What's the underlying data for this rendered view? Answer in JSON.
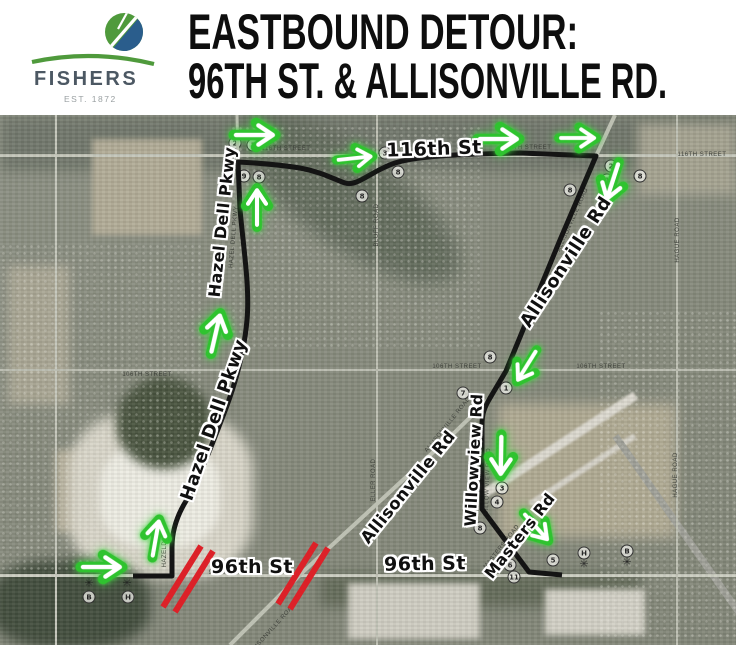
{
  "header": {
    "logo": {
      "name": "FISHERS",
      "est": "EST. 1872",
      "green": "#4f9a3c",
      "blue": "#2a5d8c"
    },
    "title_line1": "EASTBOUND DETOUR:",
    "title_line2": "96TH ST. & ALLISONVILLE RD."
  },
  "map": {
    "colors": {
      "route": "#141414",
      "arrow_green": "#2fc32f",
      "closure_red": "#dc2128"
    },
    "star": "✳",
    "route_labels": [
      {
        "text": "116th St"
      },
      {
        "text": "Hazel Dell Pkwy"
      },
      {
        "text": "Hazel Dell Pkwy"
      },
      {
        "text": "Allisonville Rd"
      },
      {
        "text": "Allisonville Rd"
      },
      {
        "text": "Willowview Rd"
      },
      {
        "text": "Masters Rd"
      },
      {
        "text": "96th St"
      },
      {
        "text": "96th St"
      }
    ],
    "base_labels": [
      {
        "text": "116TH STREET"
      },
      {
        "text": "116TH STREET"
      },
      {
        "text": "116TH STREET"
      },
      {
        "text": "106TH STREET"
      },
      {
        "text": "106TH STREET"
      },
      {
        "text": "106TH STREET"
      },
      {
        "text": "96TH"
      },
      {
        "text": "BLUFF ROAD"
      },
      {
        "text": "ELLER ROAD"
      },
      {
        "text": "HAGUE ROAD"
      },
      {
        "text": "HAGUE ROAD"
      },
      {
        "text": "ALLISONVILLE ROAD"
      },
      {
        "text": "ALLISONVILLE ROAD"
      },
      {
        "text": "ALLISONVILLE ROAD"
      },
      {
        "text": "WILLOW VIEW ROAD"
      },
      {
        "text": "MASTERS ROAD"
      },
      {
        "text": "HAZEL DELL PKWY"
      },
      {
        "text": "HAZELDELL"
      }
    ],
    "markers": [
      {
        "t": "2"
      },
      {
        "t": "1"
      },
      {
        "t": "9"
      },
      {
        "t": "8"
      },
      {
        "t": "3"
      },
      {
        "t": "8"
      },
      {
        "t": "8"
      },
      {
        "t": "2"
      },
      {
        "t": "1"
      },
      {
        "t": "8"
      },
      {
        "t": "8"
      },
      {
        "t": "8"
      },
      {
        "t": "7"
      },
      {
        "t": "1"
      },
      {
        "t": "3"
      },
      {
        "t": "4"
      },
      {
        "t": "8"
      },
      {
        "t": "5"
      },
      {
        "t": "6"
      },
      {
        "t": "11"
      },
      {
        "t": "B"
      },
      {
        "t": "H"
      },
      {
        "t": "H"
      },
      {
        "t": "B"
      }
    ],
    "arrows": [
      "right",
      "up",
      "up",
      "up",
      "right",
      "right",
      "right",
      "right",
      "down-left",
      "down-left",
      "down",
      "down-right"
    ]
  }
}
